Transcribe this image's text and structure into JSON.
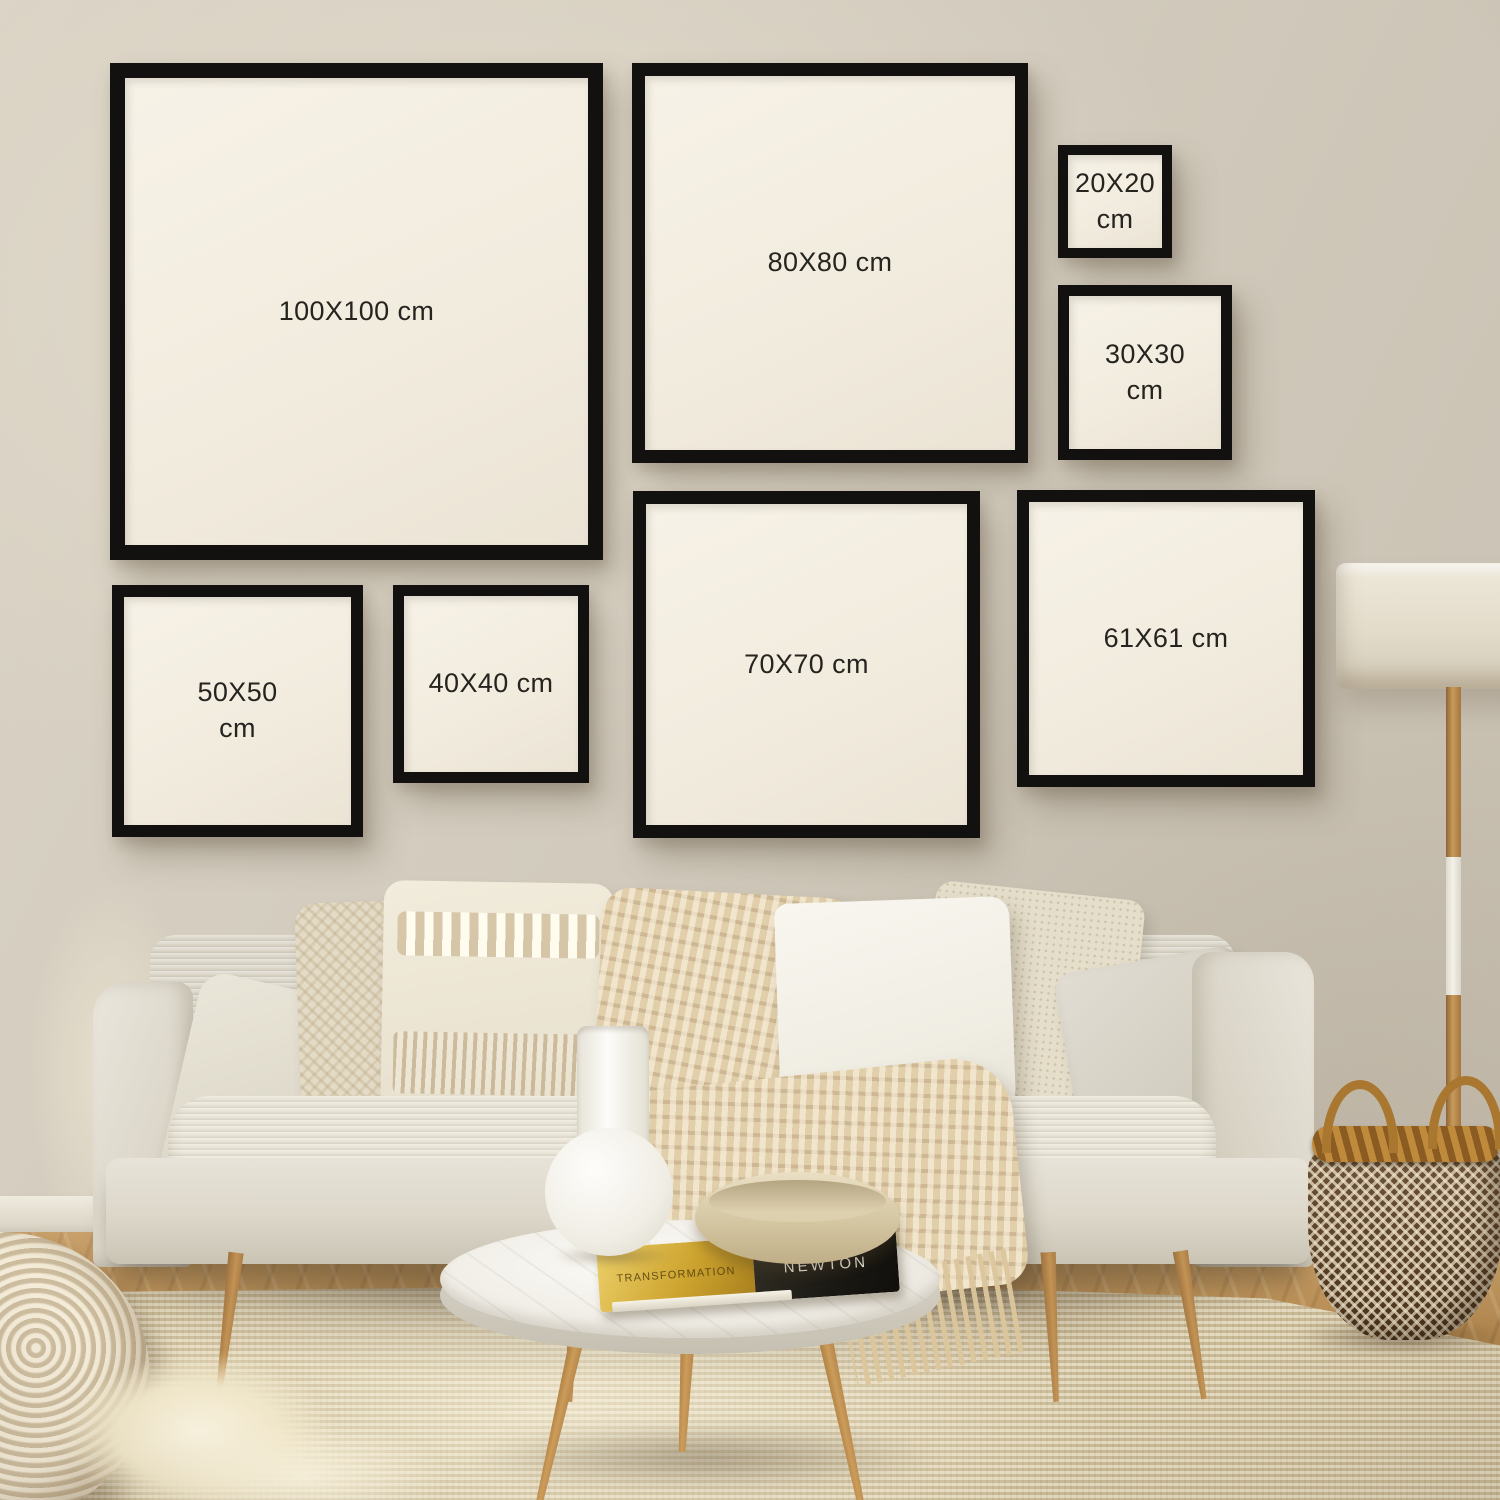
{
  "scene": {
    "type": "living-room wall-art size guide photo",
    "unit": "cm"
  },
  "frames": [
    {
      "size": "100X100",
      "unit": "cm",
      "label": "100X100 cm"
    },
    {
      "size": "80X80",
      "unit": "cm",
      "label": "80X80 cm"
    },
    {
      "size": "20X20",
      "unit": "cm",
      "label": "20X20 cm"
    },
    {
      "size": "30X30",
      "unit": "cm",
      "label": "30X30 cm"
    },
    {
      "size": "50X50",
      "unit": "cm",
      "label": "50X50 cm"
    },
    {
      "size": "40X40",
      "unit": "cm",
      "label": "40X40 cm"
    },
    {
      "size": "70X70",
      "unit": "cm",
      "label": "70X70 cm"
    },
    {
      "size": "61X61",
      "unit": "cm",
      "label": "61X61 cm"
    }
  ],
  "book": {
    "spine_title": "NEWTON",
    "spine_text": "TRANSFORMATION"
  },
  "colors": {
    "frame_border": "#131110",
    "frame_mat": "#f3eee2",
    "label_text": "#26241f",
    "wall": "#d4ccbe",
    "wood_floor": "#b5894f",
    "rug": "#d8cbaa",
    "sofa": "#e4e0d5",
    "throw": "#e1ceaa",
    "basket_dark": "#5e4122",
    "basket_light": "#f0e4ca",
    "lamp_shade": "#e8e1d1",
    "book_gold": "#cda42f",
    "book_black": "#1b1914"
  }
}
